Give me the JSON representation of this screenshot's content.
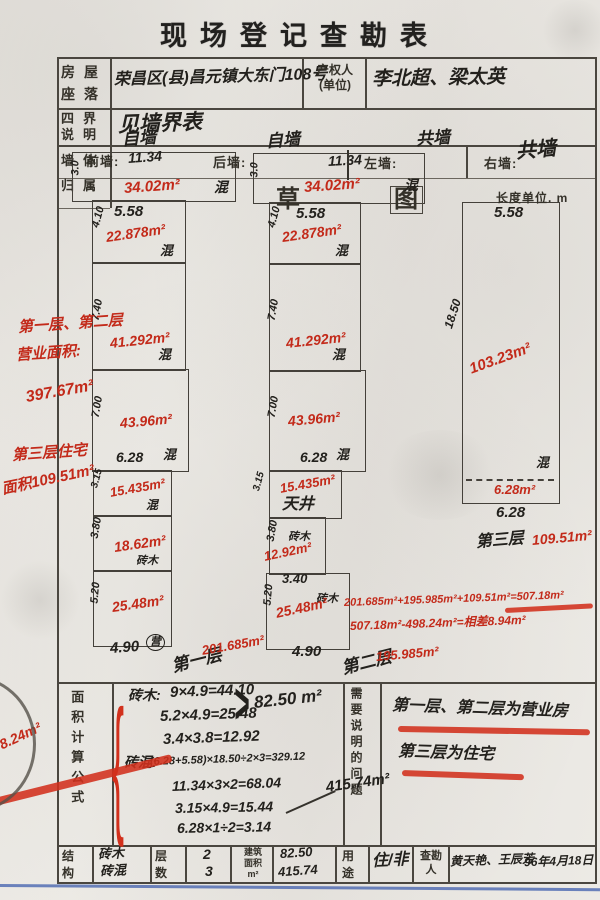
{
  "title": "现场登记查勘表",
  "form": {
    "house_location_label": "房屋座落",
    "house_location_value": "荣昌区(县)昌元镇大东门108号",
    "owner_label": "产权人\n(单位)",
    "owner_value": "李北超、梁太英",
    "boundaries_label": "四界说明",
    "boundaries_value": "见墙界表",
    "walls_label": "墙体归属",
    "area_formula_label": "面积计算公式",
    "notes_label": "需要说明的问题",
    "footer": {
      "structure_label": "结构",
      "structure_values": [
        "砖木",
        "砖混"
      ],
      "floors_label": "层数",
      "floors_values": [
        "2",
        "3"
      ],
      "area_label": "建筑\n面积\nm²",
      "area_values": [
        "82.50",
        "415.74"
      ],
      "use_label": "用途",
      "use_value": "住/非",
      "surveyor_label": "查勘\n人",
      "surveyor_value": "黄天艳、王辰芳",
      "date_value": "96年4月18日"
    }
  },
  "sketch": {
    "boxes": [
      {
        "x": 72,
        "y": 152,
        "w": 162,
        "h": 48
      },
      {
        "x": 92,
        "y": 200,
        "w": 92,
        "h": 62
      },
      {
        "x": 92,
        "y": 262,
        "w": 92,
        "h": 107
      },
      {
        "x": 92,
        "y": 369,
        "w": 95,
        "h": 101
      },
      {
        "x": 93,
        "y": 470,
        "w": 77,
        "h": 45
      },
      {
        "x": 93,
        "y": 515,
        "w": 77,
        "h": 55
      },
      {
        "x": 93,
        "y": 570,
        "w": 77,
        "h": 75
      },
      {
        "x": 253,
        "y": 153,
        "w": 170,
        "h": 49
      },
      {
        "x": 269,
        "y": 202,
        "w": 90,
        "h": 61
      },
      {
        "x": 269,
        "y": 263,
        "w": 90,
        "h": 107
      },
      {
        "x": 269,
        "y": 370,
        "w": 95,
        "h": 100
      },
      {
        "x": 269,
        "y": 470,
        "w": 71,
        "h": 47
      },
      {
        "x": 269,
        "y": 517,
        "w": 55,
        "h": 56
      },
      {
        "x": 266,
        "y": 573,
        "w": 82,
        "h": 75
      },
      {
        "x": 462,
        "y": 202,
        "w": 96,
        "h": 300
      }
    ],
    "labels": [
      {
        "t": "自墙",
        "x": 122,
        "y": 131,
        "s": 17,
        "r": -4,
        "c": "ink"
      },
      {
        "t": "前墙:",
        "x": 86,
        "y": 155,
        "s": 13,
        "c": "print"
      },
      {
        "t": "11.34",
        "x": 128,
        "y": 151,
        "s": 14,
        "r": -4,
        "c": "ink"
      },
      {
        "t": "后墙:",
        "x": 213,
        "y": 156,
        "s": 13,
        "c": "print"
      },
      {
        "t": "自墙",
        "x": 266,
        "y": 133,
        "s": 17,
        "r": -4,
        "c": "ink"
      },
      {
        "t": "共墙",
        "x": 416,
        "y": 131,
        "s": 17,
        "r": -4,
        "c": "ink"
      },
      {
        "t": "11.34",
        "x": 328,
        "y": 154,
        "s": 14,
        "r": -3,
        "c": "ink"
      },
      {
        "t": "左墙:",
        "x": 364,
        "y": 157,
        "s": 13,
        "c": "print"
      },
      {
        "t": "右墙:",
        "x": 484,
        "y": 157,
        "s": 13,
        "c": "print"
      },
      {
        "t": "共墙",
        "x": 516,
        "y": 142,
        "s": 20,
        "r": -5,
        "c": "ink"
      },
      {
        "t": "草",
        "x": 276,
        "y": 188,
        "s": 24,
        "c": "print"
      },
      {
        "t": "图",
        "x": 390,
        "y": 186,
        "s": 24,
        "c": "print print boxed"
      },
      {
        "t": "长度单位. m",
        "x": 496,
        "y": 192,
        "s": 12,
        "c": "print"
      },
      {
        "t": "3.0",
        "x": 76,
        "y": 170,
        "s": 11,
        "r": -90,
        "c": "ink"
      },
      {
        "t": "34.02m²",
        "x": 124,
        "y": 181,
        "s": 15,
        "r": -4,
        "c": "red"
      },
      {
        "t": "混",
        "x": 214,
        "y": 180,
        "s": 14,
        "c": "ink"
      },
      {
        "t": "5.58",
        "x": 114,
        "y": 204,
        "s": 15,
        "c": "ink"
      },
      {
        "t": "4.10",
        "x": 96,
        "y": 222,
        "s": 11,
        "r": -75,
        "c": "ink"
      },
      {
        "t": "22.878m²",
        "x": 106,
        "y": 230,
        "s": 14,
        "r": -8,
        "c": "red"
      },
      {
        "t": "混",
        "x": 160,
        "y": 244,
        "s": 13,
        "c": "ink"
      },
      {
        "t": "7.40",
        "x": 96,
        "y": 315,
        "s": 11,
        "r": -80,
        "c": "ink"
      },
      {
        "t": "41.292m²",
        "x": 110,
        "y": 336,
        "s": 14,
        "r": -6,
        "c": "red"
      },
      {
        "t": "混",
        "x": 158,
        "y": 348,
        "s": 13,
        "c": "ink"
      },
      {
        "t": "7.00",
        "x": 96,
        "y": 412,
        "s": 11,
        "r": -80,
        "c": "ink"
      },
      {
        "t": "43.96m²",
        "x": 120,
        "y": 416,
        "s": 14,
        "r": -5,
        "c": "red"
      },
      {
        "t": "6.28",
        "x": 116,
        "y": 450,
        "s": 14,
        "c": "ink"
      },
      {
        "t": "混",
        "x": 163,
        "y": 448,
        "s": 13,
        "c": "ink"
      },
      {
        "t": "3.15",
        "x": 95,
        "y": 483,
        "s": 10,
        "r": -75,
        "c": "ink"
      },
      {
        "t": "15.435m²",
        "x": 110,
        "y": 486,
        "s": 13,
        "r": -10,
        "c": "red"
      },
      {
        "t": "混",
        "x": 146,
        "y": 499,
        "s": 12,
        "c": "ink"
      },
      {
        "t": "3.80",
        "x": 95,
        "y": 533,
        "s": 11,
        "r": -80,
        "c": "ink"
      },
      {
        "t": "18.62m²",
        "x": 114,
        "y": 540,
        "s": 14,
        "r": -8,
        "c": "red"
      },
      {
        "t": "砖木",
        "x": 136,
        "y": 556,
        "s": 11,
        "c": "ink"
      },
      {
        "t": "5.20",
        "x": 95,
        "y": 598,
        "s": 11,
        "r": -85,
        "c": "ink"
      },
      {
        "t": "25.48m²",
        "x": 112,
        "y": 600,
        "s": 14,
        "r": -8,
        "c": "red"
      },
      {
        "t": "4.90",
        "x": 110,
        "y": 641,
        "s": 15,
        "r": -4,
        "c": "ink"
      },
      {
        "t": "营",
        "x": 146,
        "y": 634,
        "s": 11,
        "c": "ink circled"
      },
      {
        "t": "第一层",
        "x": 172,
        "y": 658,
        "s": 17,
        "r": -14,
        "c": "ink"
      },
      {
        "t": "201.685m²",
        "x": 202,
        "y": 644,
        "s": 13,
        "r": -10,
        "c": "red"
      },
      {
        "t": "3.0",
        "x": 255,
        "y": 172,
        "s": 11,
        "r": -90,
        "c": "ink"
      },
      {
        "t": "34.02m²",
        "x": 304,
        "y": 180,
        "s": 15,
        "r": -4,
        "c": "red"
      },
      {
        "t": "混",
        "x": 404,
        "y": 178,
        "s": 14,
        "c": "ink"
      },
      {
        "t": "5.58",
        "x": 296,
        "y": 206,
        "s": 15,
        "c": "ink"
      },
      {
        "t": "4.10",
        "x": 272,
        "y": 222,
        "s": 11,
        "r": -75,
        "c": "ink"
      },
      {
        "t": "22.878m²",
        "x": 282,
        "y": 230,
        "s": 14,
        "r": -8,
        "c": "red"
      },
      {
        "t": "混",
        "x": 335,
        "y": 244,
        "s": 13,
        "c": "ink"
      },
      {
        "t": "7.40",
        "x": 272,
        "y": 315,
        "s": 11,
        "r": -80,
        "c": "ink"
      },
      {
        "t": "41.292m²",
        "x": 286,
        "y": 336,
        "s": 14,
        "r": -6,
        "c": "red"
      },
      {
        "t": "混",
        "x": 332,
        "y": 348,
        "s": 13,
        "c": "ink"
      },
      {
        "t": "7.00",
        "x": 272,
        "y": 412,
        "s": 11,
        "r": -80,
        "c": "ink"
      },
      {
        "t": "43.96m²",
        "x": 288,
        "y": 414,
        "s": 14,
        "r": -5,
        "c": "red"
      },
      {
        "t": "6.28",
        "x": 300,
        "y": 450,
        "s": 14,
        "c": "ink"
      },
      {
        "t": "混",
        "x": 336,
        "y": 448,
        "s": 13,
        "c": "ink"
      },
      {
        "t": "3.15",
        "x": 257,
        "y": 486,
        "s": 10,
        "r": -75,
        "c": "ink"
      },
      {
        "t": "15.435m²",
        "x": 280,
        "y": 482,
        "s": 13,
        "r": -10,
        "c": "red"
      },
      {
        "t": "天井",
        "x": 282,
        "y": 497,
        "s": 16,
        "c": "ink"
      },
      {
        "t": "砖木",
        "x": 288,
        "y": 532,
        "s": 11,
        "c": "ink"
      },
      {
        "t": "12.92m²",
        "x": 264,
        "y": 550,
        "s": 13,
        "r": -12,
        "c": "red"
      },
      {
        "t": "3.40",
        "x": 282,
        "y": 572,
        "s": 13,
        "c": "ink"
      },
      {
        "t": "3.80",
        "x": 271,
        "y": 536,
        "s": 11,
        "r": -80,
        "c": "ink"
      },
      {
        "t": "砖木",
        "x": 316,
        "y": 594,
        "s": 11,
        "c": "ink"
      },
      {
        "t": "5.20",
        "x": 268,
        "y": 600,
        "s": 11,
        "r": -85,
        "c": "ink"
      },
      {
        "t": "25.48m²",
        "x": 276,
        "y": 606,
        "s": 14,
        "r": -12,
        "c": "red"
      },
      {
        "t": "4.90",
        "x": 292,
        "y": 644,
        "s": 15,
        "c": "ink"
      },
      {
        "t": "第二层",
        "x": 342,
        "y": 660,
        "s": 17,
        "r": -14,
        "c": "ink"
      },
      {
        "t": "195.985m²",
        "x": 376,
        "y": 650,
        "s": 13,
        "r": -5,
        "c": "red"
      },
      {
        "t": "5.58",
        "x": 494,
        "y": 205,
        "s": 15,
        "c": "ink"
      },
      {
        "t": "18.50",
        "x": 448,
        "y": 322,
        "s": 12,
        "r": -72,
        "c": "ink"
      },
      {
        "t": "103.23m²",
        "x": 470,
        "y": 362,
        "s": 15,
        "r": -20,
        "c": "red"
      },
      {
        "t": "混",
        "x": 536,
        "y": 456,
        "s": 13,
        "c": "ink"
      },
      {
        "t": "6.28m²",
        "x": 494,
        "y": 483,
        "s": 13,
        "c": "red"
      },
      {
        "t": "6.28",
        "x": 496,
        "y": 505,
        "s": 15,
        "c": "ink"
      },
      {
        "t": "第三层",
        "x": 476,
        "y": 535,
        "s": 16,
        "r": -5,
        "c": "ink"
      },
      {
        "t": "109.51m²",
        "x": 532,
        "y": 533,
        "s": 14,
        "r": -5,
        "c": "red"
      },
      {
        "t": "第一层、第二层",
        "x": 18,
        "y": 320,
        "s": 15,
        "r": -4,
        "c": "red"
      },
      {
        "t": "营业面积:",
        "x": 16,
        "y": 348,
        "s": 15,
        "r": -4,
        "c": "red"
      },
      {
        "t": "397.67m²",
        "x": 26,
        "y": 390,
        "s": 16,
        "r": -10,
        "c": "red"
      },
      {
        "t": "第三层住宅",
        "x": 12,
        "y": 448,
        "s": 15,
        "r": -4,
        "c": "red"
      },
      {
        "t": "面积109.51m²",
        "x": 2,
        "y": 482,
        "s": 15,
        "r": -12,
        "c": "red"
      },
      {
        "t": "201.685m²+195.985m²+109.51m²=507.18m²",
        "x": 344,
        "y": 598,
        "s": 11,
        "r": -2,
        "c": "red"
      },
      {
        "t": "507.18m²-498.24m²=相差8.94m²",
        "x": 350,
        "y": 620,
        "s": 12,
        "r": -2,
        "c": "red"
      },
      {
        "t": "砖木:",
        "x": 128,
        "y": 688,
        "s": 14,
        "c": "ink"
      },
      {
        "t": "9×4.9=44.10",
        "x": 170,
        "y": 685,
        "s": 15,
        "r": -2,
        "c": "ink"
      },
      {
        "t": "5.2×4.9=25.48",
        "x": 160,
        "y": 709,
        "s": 15,
        "r": -2,
        "c": "ink"
      },
      {
        "t": "3.4×3.8=12.92",
        "x": 163,
        "y": 732,
        "s": 15,
        "r": -2,
        "c": "ink"
      },
      {
        "t": ">",
        "x": 234,
        "y": 690,
        "s": 26,
        "c": "ink",
        "sy": 2.2
      },
      {
        "t": "82.50 m²",
        "x": 254,
        "y": 694,
        "s": 17,
        "r": -6,
        "c": "ink"
      },
      {
        "t": "砖混:",
        "x": 124,
        "y": 755,
        "s": 14,
        "c": "ink"
      },
      {
        "t": "(6.28+5.58)×18.50÷2×3=329.12",
        "x": 150,
        "y": 757,
        "s": 11,
        "r": -2,
        "c": "ink"
      },
      {
        "t": "11.34×3×2=68.04",
        "x": 172,
        "y": 779,
        "s": 14,
        "r": -2,
        "c": "ink"
      },
      {
        "t": "3.15×4.9=15.44",
        "x": 175,
        "y": 801,
        "s": 14,
        "r": -1,
        "c": "ink"
      },
      {
        "t": "6.28×1÷2=3.14",
        "x": 177,
        "y": 821,
        "s": 14,
        "r": -1,
        "c": "ink"
      },
      {
        "t": "415.74m²",
        "x": 326,
        "y": 780,
        "s": 15,
        "r": -8,
        "c": "ink"
      },
      {
        "t": "{",
        "x": 112,
        "y": 747,
        "s": 36,
        "c": "redbrace",
        "sy": 4.2
      },
      {
        "t": "8.24m²",
        "x": 0,
        "y": 738,
        "s": 14,
        "r": -25,
        "c": "red"
      },
      {
        "t": "第一层、第二层为营业房",
        "x": 392,
        "y": 698,
        "s": 16,
        "r": 2,
        "c": "ink"
      },
      {
        "t": "第三层为住宅",
        "x": 398,
        "y": 744,
        "s": 16,
        "r": 2,
        "c": "ink"
      }
    ],
    "strokes": [
      {
        "x": 505,
        "y": 608,
        "w": 88,
        "h": 5,
        "r": -3,
        "c": "redstroke"
      },
      {
        "x": 398,
        "y": 726,
        "w": 192,
        "h": 6,
        "r": 1,
        "c": "redstroke"
      },
      {
        "x": 402,
        "y": 770,
        "w": 122,
        "h": 6,
        "r": 2,
        "c": "redstroke"
      },
      {
        "x": -5,
        "y": 798,
        "w": 182,
        "h": 8,
        "r": -14,
        "c": "redstroke"
      },
      {
        "x": 0,
        "y": 884,
        "w": 600,
        "h": 3,
        "r": 0.4,
        "c": "bluestroke"
      },
      {
        "x": 286,
        "y": 812,
        "w": 54,
        "h": 2,
        "r": -24,
        "c": "inkstroke"
      },
      {
        "x": 347,
        "y": 150,
        "w": 2,
        "h": 30,
        "r": 0,
        "c": "inkstroke"
      },
      {
        "x": 466,
        "y": 479,
        "w": 88,
        "h": 2,
        "r": 0,
        "c": "dashstroke"
      },
      {
        "x": -88,
        "y": 676,
        "w": 118,
        "h": 130,
        "r": 0,
        "c": "arcstroke"
      }
    ]
  }
}
